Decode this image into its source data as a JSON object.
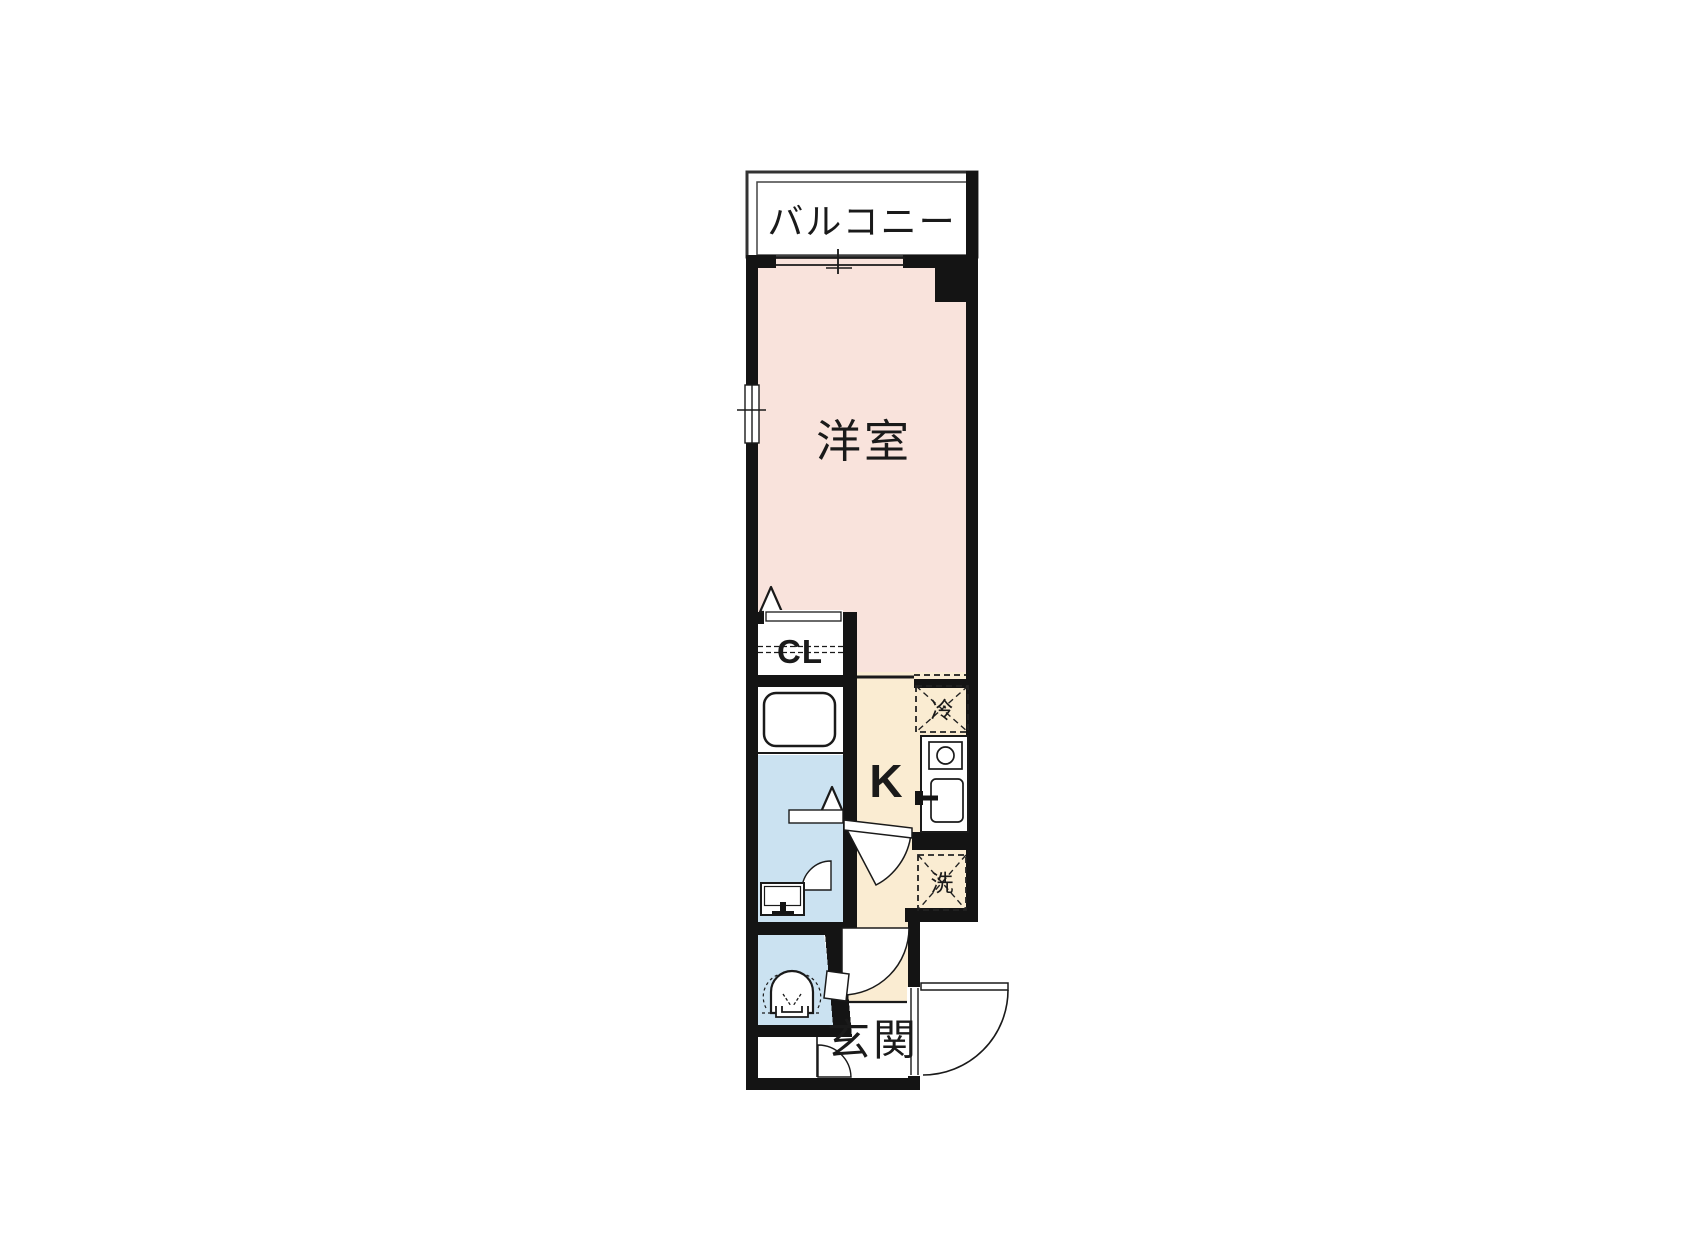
{
  "title": "1K apartment floor plan",
  "labels": {
    "balcony": "バルコニー",
    "western_room": "洋室",
    "closet": "CL",
    "kitchen": "K",
    "entrance": "玄関",
    "refrigerator": "冷",
    "washing_machine": "洗"
  },
  "rooms": [
    {
      "name": "バルコニー",
      "type": "balcony"
    },
    {
      "name": "洋室",
      "type": "western-style room"
    },
    {
      "name": "CL",
      "type": "closet"
    },
    {
      "name": "K",
      "type": "kitchen corridor"
    },
    {
      "name": "玄関",
      "type": "entrance"
    },
    {
      "name": "bathroom",
      "type": "unit bath with tub"
    },
    {
      "name": "washroom",
      "type": "washbasin area"
    },
    {
      "name": "toilet room",
      "type": "WC"
    }
  ],
  "fixtures": [
    "bathtub",
    "washbasin",
    "toilet",
    "kitchen-stove",
    "kitchen-sink",
    "refrigerator-space",
    "washing-machine-space",
    "sliding-window",
    "entrance-door",
    "hinged-doors",
    "folding-door-markers"
  ],
  "colors": {
    "room_pink": "#F9E3DC",
    "kitchen_cream": "#FAECD2",
    "wet_area_blue": "#CBE2F1",
    "wall_black": "#141414",
    "line_dark": "#222222",
    "background": "#FFFFFF"
  }
}
